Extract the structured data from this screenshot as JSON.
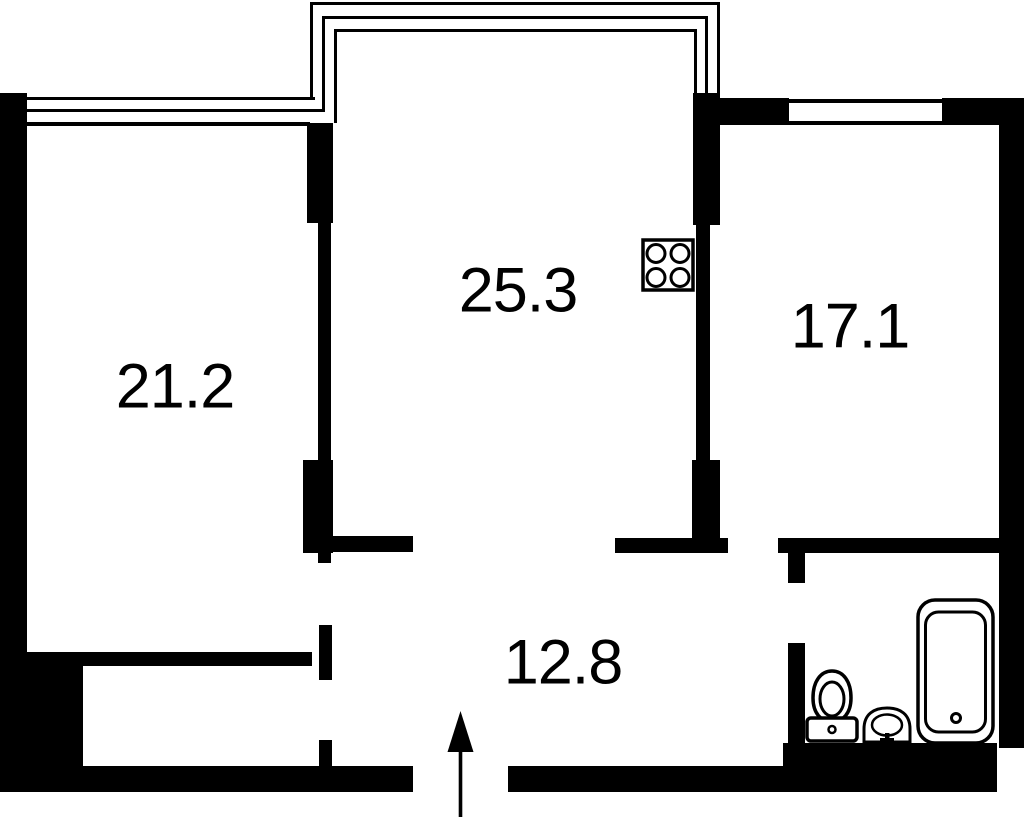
{
  "floorplan": {
    "colors": {
      "walls": "#000000",
      "background": "#ffffff"
    },
    "rooms": [
      {
        "id": "room-left",
        "area": "21.2"
      },
      {
        "id": "room-center",
        "area": "25.3"
      },
      {
        "id": "room-right",
        "area": "17.1"
      },
      {
        "id": "hallway",
        "area": "12.8"
      }
    ],
    "fixtures": [
      {
        "icon": "stove-icon"
      },
      {
        "icon": "toilet-icon"
      },
      {
        "icon": "sink-icon"
      },
      {
        "icon": "bathtub-icon"
      },
      {
        "icon": "entrance-arrow-icon"
      }
    ]
  }
}
